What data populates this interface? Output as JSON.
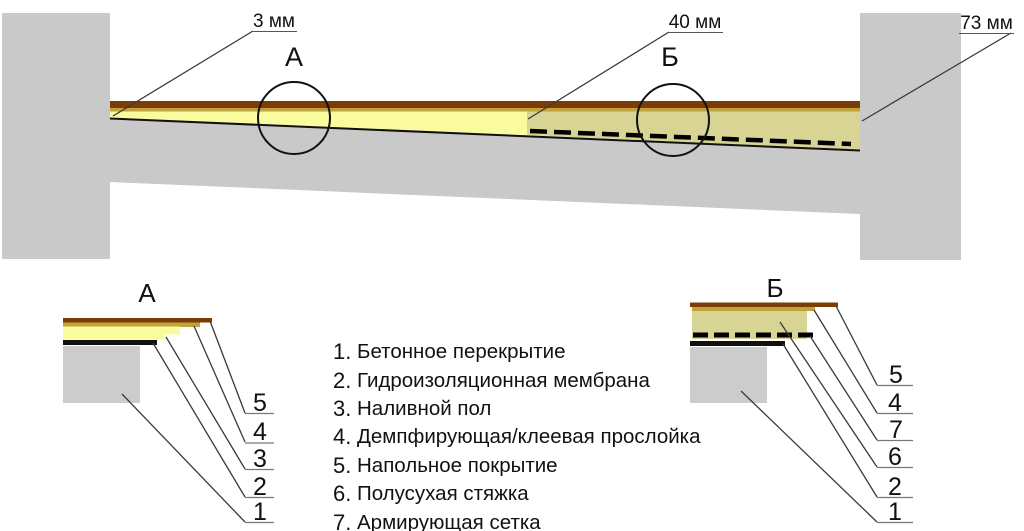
{
  "diagram": {
    "dimensions": {
      "left": "3 мм",
      "middle": "40 мм",
      "right": "73 мм"
    },
    "callout_a": "А",
    "callout_b": "Б"
  },
  "details": {
    "a": {
      "title": "А",
      "numbers": [
        "5",
        "4",
        "3",
        "2",
        "1"
      ]
    },
    "b": {
      "title": "Б",
      "numbers": [
        "5",
        "4",
        "7",
        "6",
        "2",
        "1"
      ]
    }
  },
  "legend": {
    "items": [
      {
        "num": "1.",
        "label": "Бетонное перекрытие"
      },
      {
        "num": "2.",
        "label": "Гидроизоляционная мембрана"
      },
      {
        "num": "3.",
        "label": "Наливной пол"
      },
      {
        "num": "4.",
        "label": "Демпфирующая/клеевая прослойка"
      },
      {
        "num": "5.",
        "label": "Напольное покрытие"
      },
      {
        "num": "6.",
        "label": "Полусухая стяжка"
      },
      {
        "num": "7.",
        "label": "Армирующая сетка"
      }
    ]
  },
  "colors": {
    "concrete_gray": "#c9c9c9",
    "leveling_floor_yellow": "#fafa9e",
    "screed_olive": "#d7d494",
    "floor_covering_brown": "#7b3c06",
    "adhesive_mustard": "#c2a23a",
    "membrane_black": "#111111",
    "leader_line": "#3a3a3a"
  }
}
